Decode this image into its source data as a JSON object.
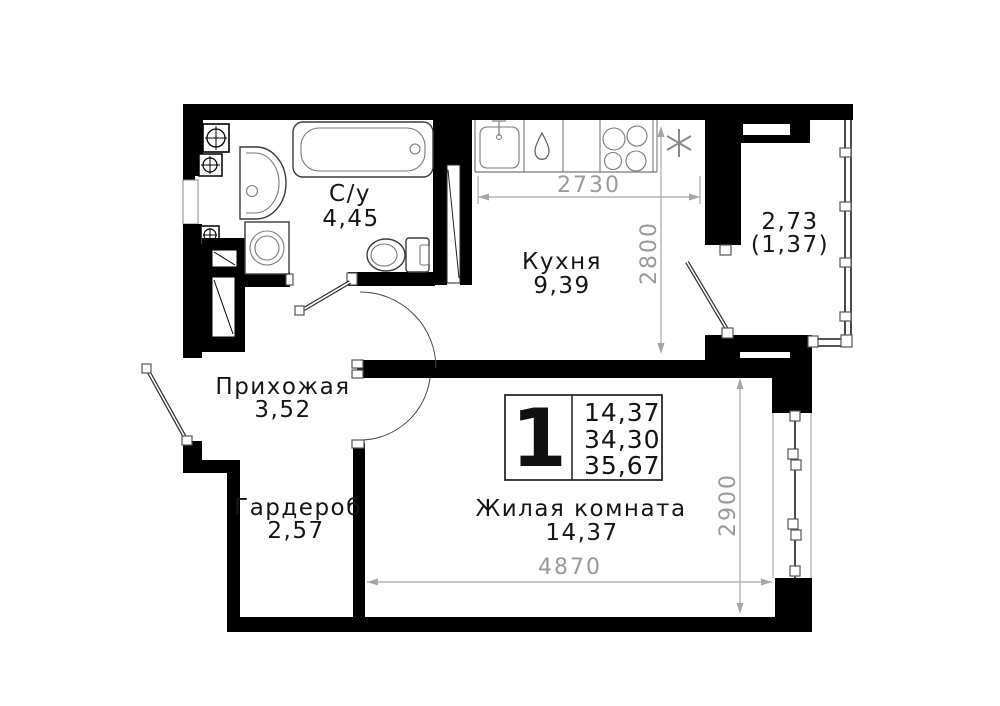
{
  "plan": {
    "title": "1-room apartment floor plan",
    "rooms": [
      {
        "name": "С/у",
        "area": "4,45"
      },
      {
        "name": "Кухня",
        "area": "9,39"
      },
      {
        "name": "Прихожая",
        "area": "3,52"
      },
      {
        "name": "Гардероб",
        "area": "2,57"
      },
      {
        "name": "Жилая комната",
        "area": "14,37"
      }
    ],
    "balcony": {
      "area": "2,73",
      "area_reduced": "(1,37)"
    },
    "info_box": {
      "rooms_count": "1",
      "values": [
        "14,37",
        "34,30",
        "35,67"
      ]
    },
    "dimensions": {
      "kitchen_width": "2730",
      "kitchen_depth": "2800",
      "living_width": "4870",
      "living_depth": "2900"
    },
    "colors": {
      "walls": "#000000",
      "dimension_gray": "#9a9a9a",
      "label_black": "#161616",
      "background": "#ffffff"
    }
  }
}
